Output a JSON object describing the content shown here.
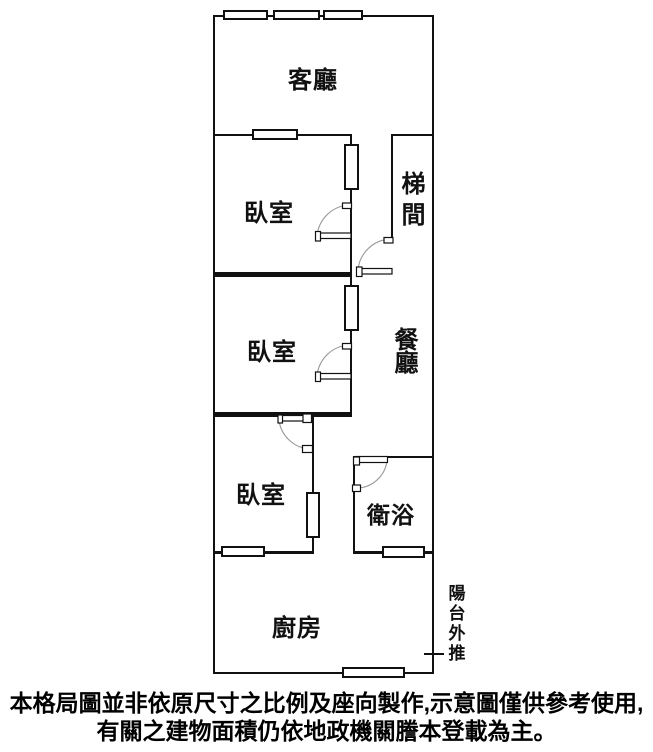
{
  "floor_plan": {
    "rooms": {
      "living": {
        "label": "客廳"
      },
      "bedroom1": {
        "label": "臥室"
      },
      "stairwell": {
        "label": "梯間"
      },
      "bedroom2": {
        "label": "臥室"
      },
      "dining": {
        "label": "餐廳"
      },
      "bedroom3": {
        "label": "臥室"
      },
      "bathroom": {
        "label": "衛浴"
      },
      "kitchen": {
        "label": "廚房"
      }
    },
    "annotation": {
      "balcony_note": "陽台外推"
    },
    "line_color": "#111111",
    "background_color": "#ffffff"
  },
  "disclaimer": {
    "line1": "本格局圖並非依原尺寸之比例及座向製作,示意圖僅供參考使用,",
    "line2": "有關之建物面積仍依地政機關謄本登載為主。"
  }
}
